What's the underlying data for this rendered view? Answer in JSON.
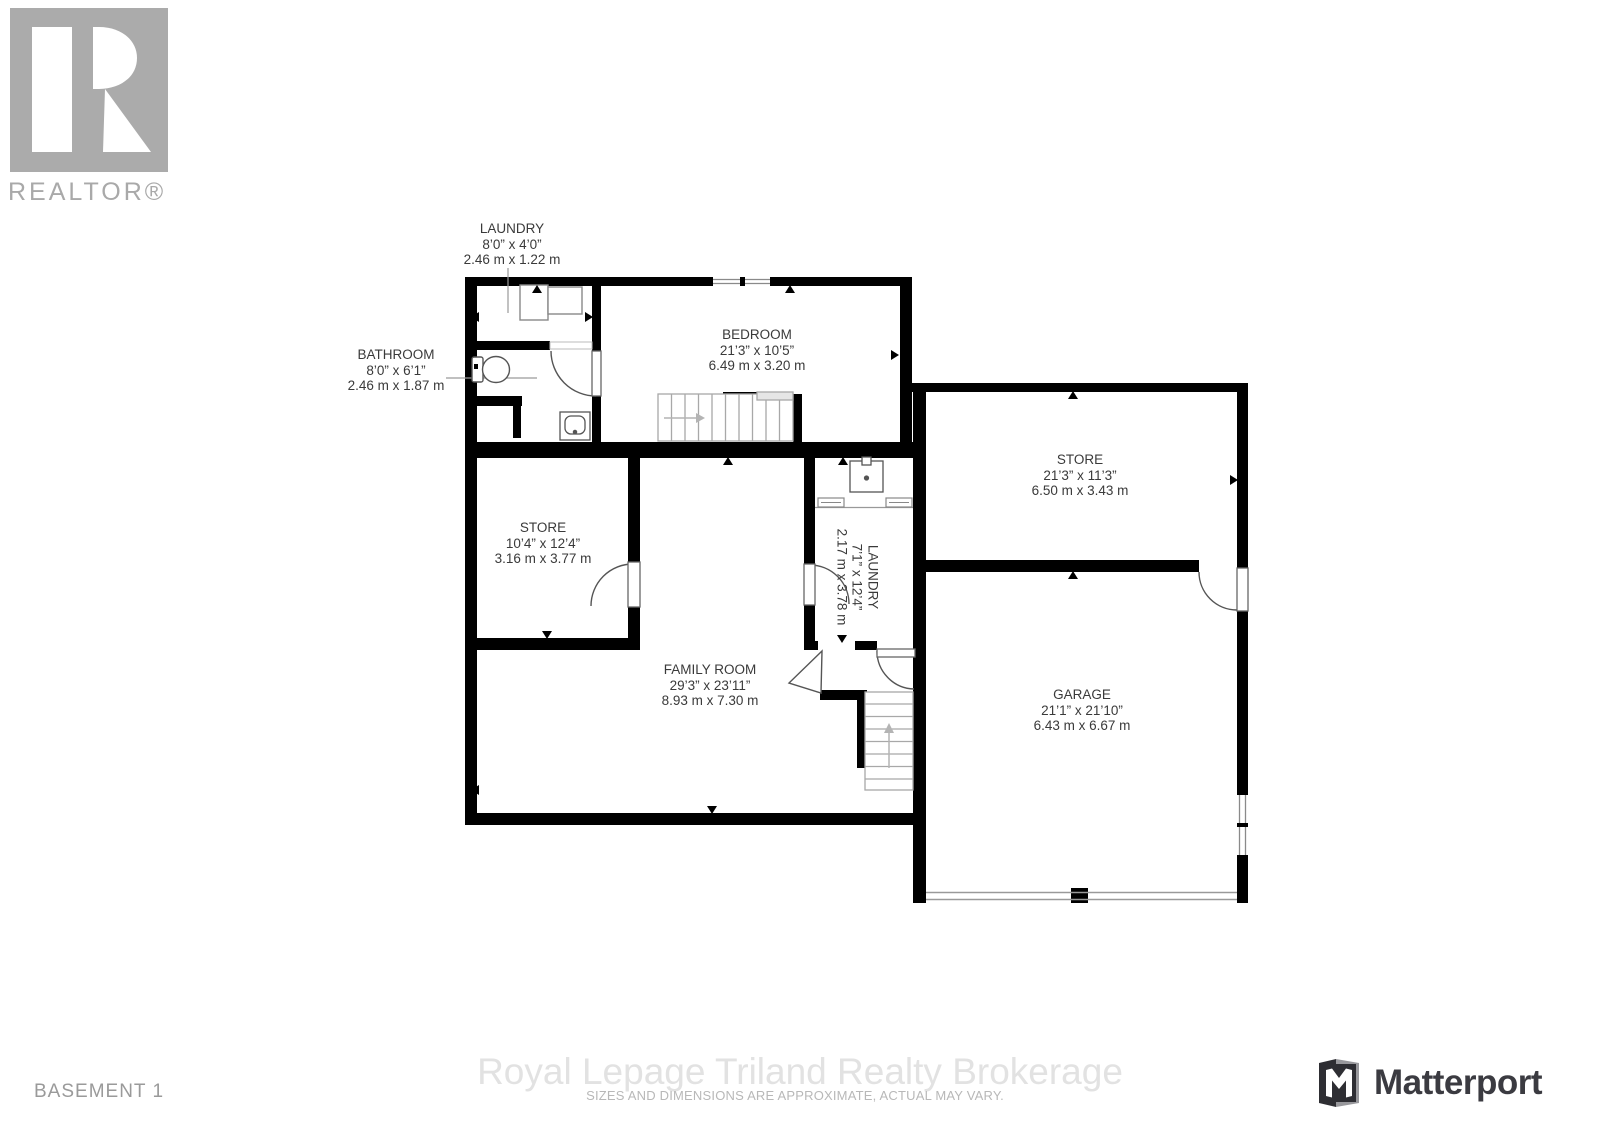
{
  "branding": {
    "realtor_logo_text": "REALTOR®",
    "matterport_text": "Matterport"
  },
  "icons": {
    "realtor_logo": "realtor-r-logo",
    "matterport_logo": "matterport-m-logo"
  },
  "floor_label": "BASEMENT 1",
  "watermark": {
    "brokerage": "Royal Lepage Triland Realty Brokerage",
    "disclaimer": "SIZES AND DIMENSIONS ARE APPROXIMATE, ACTUAL MAY VARY."
  },
  "rooms": {
    "laundry_top": {
      "name": "LAUNDRY",
      "imperial": "8’0” x 4’0”",
      "metric": "2.46 m x 1.22 m"
    },
    "bathroom": {
      "name": "BATHROOM",
      "imperial": "8’0” x 6’1”",
      "metric": "2.46 m x 1.87 m"
    },
    "bedroom": {
      "name": "BEDROOM",
      "imperial": "21’3” x 10’5”",
      "metric": "6.49 m x 3.20 m"
    },
    "store_right": {
      "name": "STORE",
      "imperial": "21’3” x 11’3”",
      "metric": "6.50 m x 3.43 m"
    },
    "store_left": {
      "name": "STORE",
      "imperial": "10’4” x 12’4”",
      "metric": "3.16 m x 3.77 m"
    },
    "laundry_mid": {
      "name": "LAUNDRY",
      "imperial": "7’1” x 12’4”",
      "metric": "2.17 m x 3.78 m"
    },
    "family_room": {
      "name": "FAMILY ROOM",
      "imperial": "29’3” x 23’11”",
      "metric": "8.93 m x 7.30 m"
    },
    "garage": {
      "name": "GARAGE",
      "imperial": "21’1” x 21’10”",
      "metric": "6.43 m x 6.67 m"
    }
  },
  "colors": {
    "wall": "#000000",
    "label_text": "#3a3a3a",
    "watermark": "#e2e2e2",
    "muted_gray": "#9a9a9a",
    "matterport_text": "#3b3b41",
    "realtor_gray": "#ababab"
  }
}
